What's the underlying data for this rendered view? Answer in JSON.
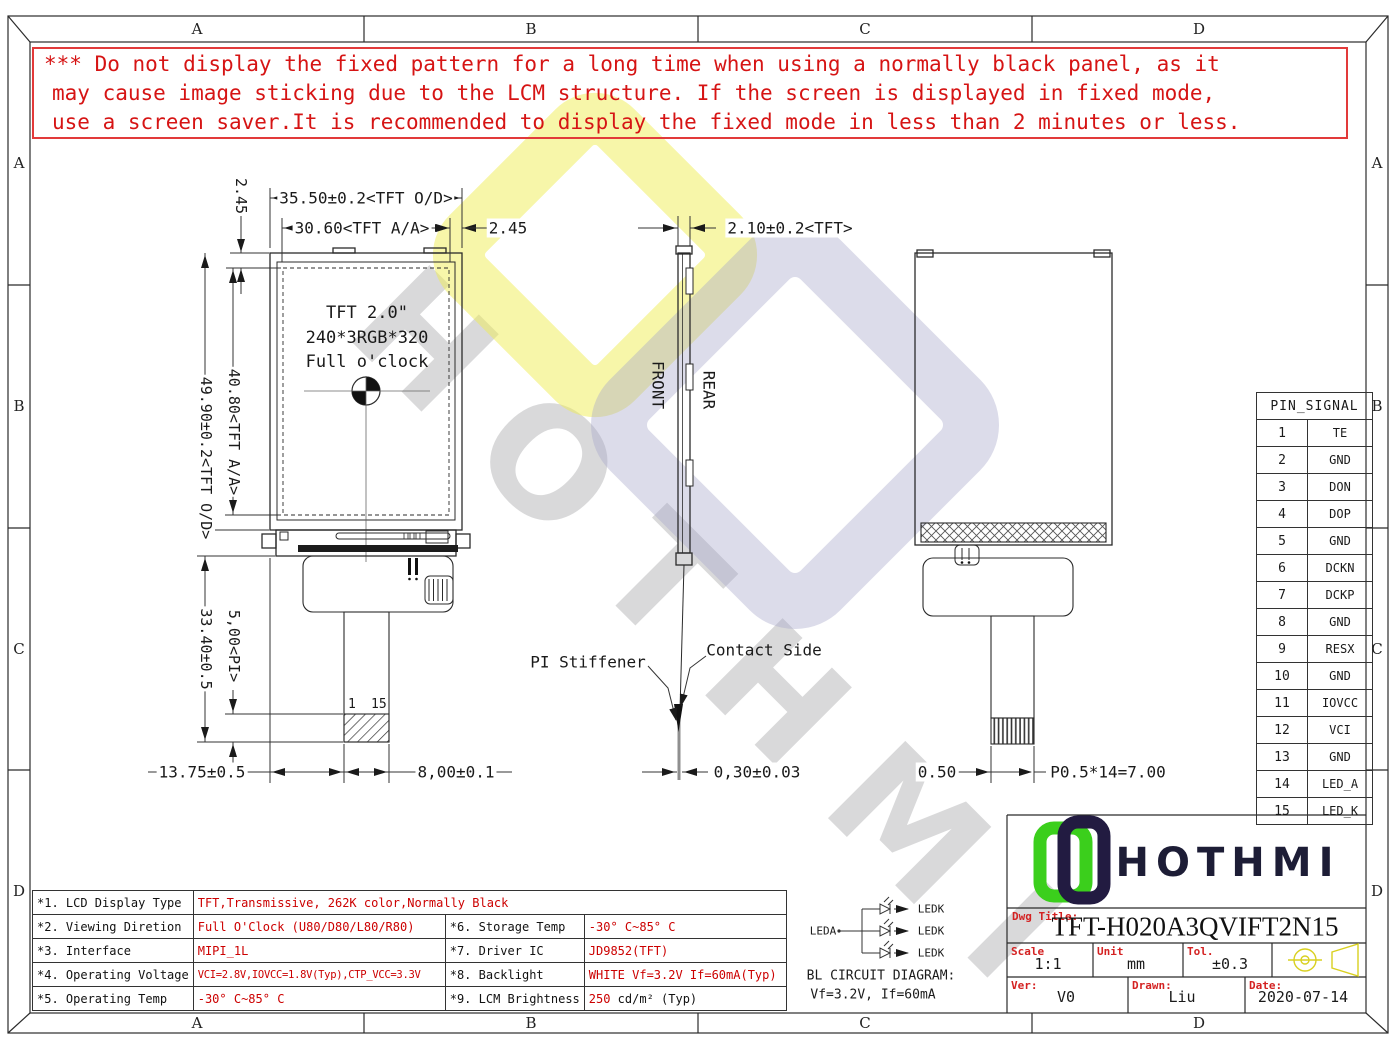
{
  "zones": {
    "top": [
      "A",
      "B",
      "C",
      "D"
    ],
    "bottom": [
      "A",
      "B",
      "C",
      "D"
    ],
    "left": [
      "A",
      "B",
      "C",
      "D"
    ],
    "right": [
      "A",
      "B",
      "C",
      "D"
    ]
  },
  "warning": {
    "lines": [
      "*** Do not display the fixed pattern for a long time when using a normally black panel, as it",
      "may cause image sticking due to the LCM structure. If the screen is displayed in fixed mode,",
      "use a screen saver.It is recommended to display the fixed mode in less than 2 minutes or less."
    ]
  },
  "watermark": {
    "text": "HOTHMI"
  },
  "front_view": {
    "title": "TFT 2.0\"",
    "resolution": "240*3RGB*320",
    "clock": "Full o'clock",
    "pin_start": "1",
    "pin_end": "15",
    "dim_width_od": "35.50±0.2<TFT O/D>",
    "dim_width_aa": "30.60<TFT A/A>",
    "dim_margin_left": "2.45",
    "dim_margin_right": "2.45",
    "dim_height_od": "49.90±0.2<TFT O/D>",
    "dim_height_aa": "40.80<TFT A/A>",
    "dim_fpc_len": "33.40±0.5",
    "dim_pi": "5,00<PI>",
    "dim_tail_offset": "13.75±0.5",
    "dim_tail_width": "8,00±0.1"
  },
  "side_view": {
    "front": "FRONT",
    "rear": "REAR",
    "dim_thickness": "2.10±0.2<TFT>",
    "dim_fpc_thickness": "0,30±0.03",
    "pi_stiffener": "PI Stiffener",
    "contact_side": "Contact Side"
  },
  "rear_view": {
    "dim_pitch_margin": "0.50",
    "dim_pitch": "P0.5*14=7.00"
  },
  "pin_table": {
    "header": "PIN_SIGNAL",
    "rows": [
      {
        "pin": "1",
        "signal": "TE"
      },
      {
        "pin": "2",
        "signal": "GND"
      },
      {
        "pin": "3",
        "signal": "DON"
      },
      {
        "pin": "4",
        "signal": "DOP"
      },
      {
        "pin": "5",
        "signal": "GND"
      },
      {
        "pin": "6",
        "signal": "DCKN"
      },
      {
        "pin": "7",
        "signal": "DCKP"
      },
      {
        "pin": "8",
        "signal": "GND"
      },
      {
        "pin": "9",
        "signal": "RESX"
      },
      {
        "pin": "10",
        "signal": "GND"
      },
      {
        "pin": "11",
        "signal": "IOVCC"
      },
      {
        "pin": "12",
        "signal": "VCI"
      },
      {
        "pin": "13",
        "signal": "GND"
      },
      {
        "pin": "14",
        "signal": "LED_A"
      },
      {
        "pin": "15",
        "signal": "LED_K"
      }
    ]
  },
  "spec_table": {
    "row1": {
      "label": "*1. LCD Display Type",
      "value": "TFT,Transmissive, 262K color,Normally Black"
    },
    "left_rows": [
      {
        "label": "*2. Viewing Diretion",
        "value": "Full O'Clock (U80/D80/L80/R80)"
      },
      {
        "label": "*3. Interface",
        "value": "MIPI_1L"
      },
      {
        "label": "*4. Operating Voltage",
        "value": "VCI=2.8V,IOVCC=1.8V(Typ),CTP_VCC=3.3V"
      },
      {
        "label": "*5. Operating Temp",
        "value": "-30° C~85° C"
      }
    ],
    "right_rows": [
      {
        "label": "*6. Storage Temp",
        "value": "-30° C~85° C"
      },
      {
        "label": "*7. Driver IC",
        "value": "JD9852(TFT)"
      },
      {
        "label": "*8. Backlight",
        "value": "WHITE Vf=3.2V If=60mA(Typ)"
      },
      {
        "label": "*9. LCM Brightness",
        "num": "250",
        "unit": "cd/m² (Typ)"
      }
    ]
  },
  "bl_circuit": {
    "leda": "LEDA",
    "ledk": "LEDK",
    "title": "BL CIRCUIT DIAGRAM:",
    "subtitle": "Vf=3.2V, If=60mA"
  },
  "title_block": {
    "brand": "HOTHMI",
    "dwg_title_label": "Dwg Title:",
    "dwg_title": "TFT-H020A3QVIFT2N15",
    "scale_label": "Scale",
    "scale": "1:1",
    "unit_label": "Unit",
    "unit": "mm",
    "tol_label": "Tol.",
    "tol": "±0.3",
    "ver_label": "Ver:",
    "ver": "V0",
    "drawn_label": "Drawn:",
    "drawn": "Liu",
    "date_label": "Date:",
    "date": "2020-07-14"
  },
  "colors": {
    "warning_red": "#d61414",
    "value_red": "#cc0000",
    "logo_green": "#3bcf1c",
    "logo_navy": "#221b41",
    "symbol_yellow": "#d9d020"
  }
}
